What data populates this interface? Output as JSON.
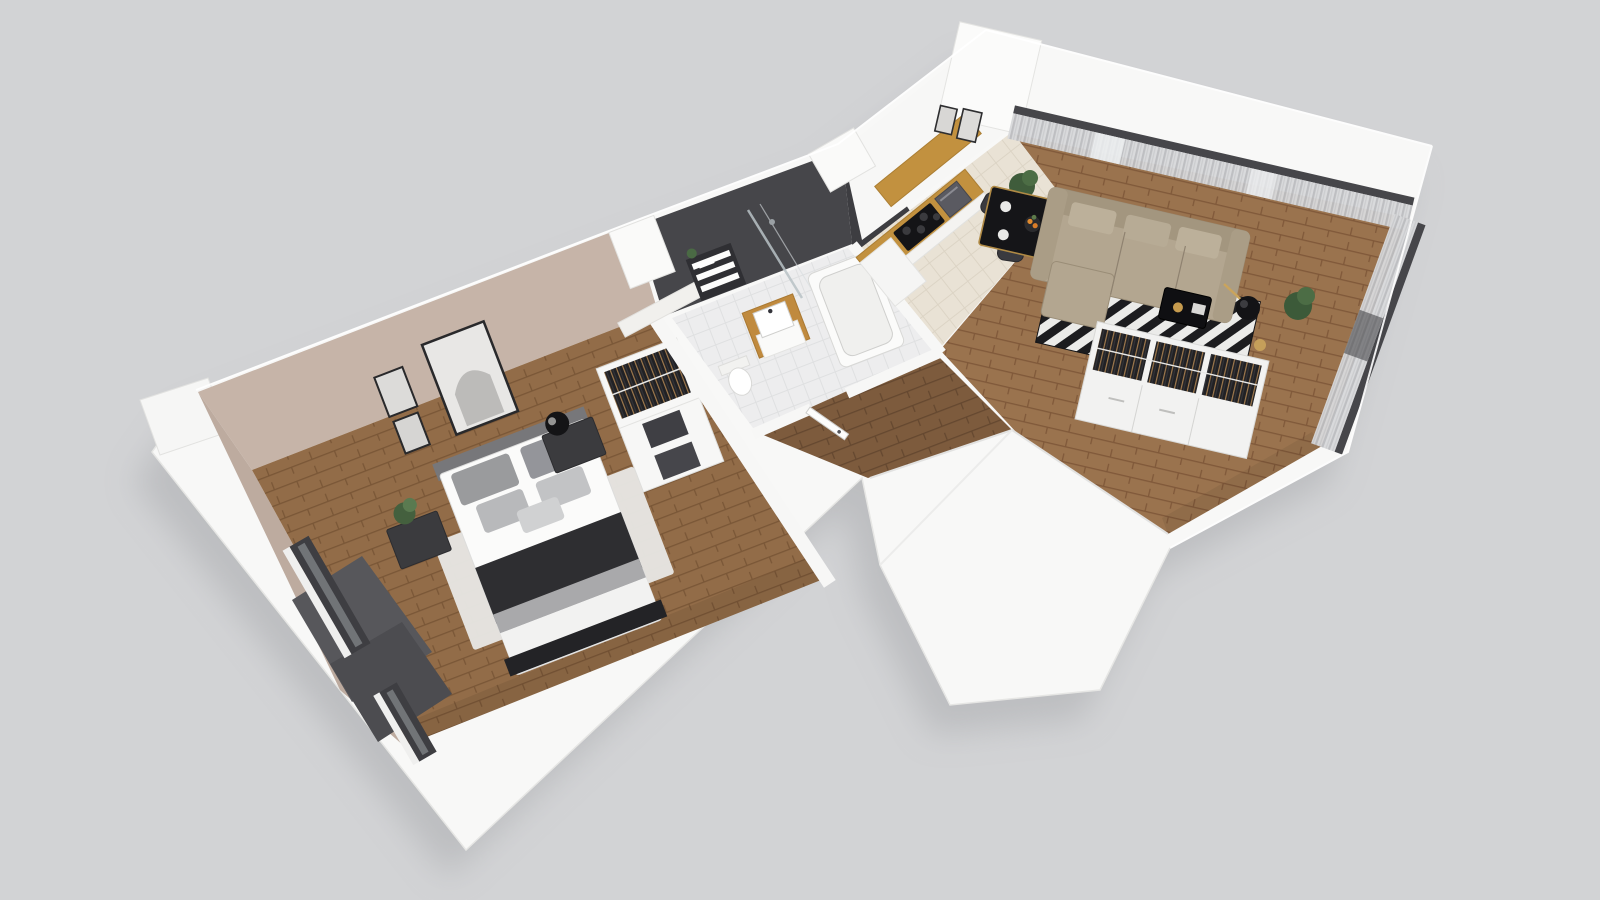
{
  "scene": {
    "type": "3d-floorplan-cutaway",
    "description": "Axonometric dollhouse cutaway view of a one-bedroom apartment floating on a plain gray background",
    "background": "#d2d3d5"
  },
  "palette": {
    "wall_white": "#f8f8f7",
    "wall_outer_shade": "#eeeeec",
    "bedroom_wall_taupe": "#c6b4a8",
    "bath_tile_dark": "#47474b",
    "bath_tile_white_brick": "#f1f0ed",
    "bedroom_floor_wood": "#926c48",
    "hall_floor_wood": "#7d5b3d",
    "living_floor_wood": "#9a734e",
    "kitchen_tile_beige": "#e9e2d5",
    "kitchen_wood_accent": "#c2913f",
    "cooktop_black": "#141417",
    "sofa_beige": "#b3a690",
    "rug_stripe_black": "#1c1c1f",
    "rug_stripe_white": "#ebebe9",
    "bedroom_rug_gray": "#e6e5e2",
    "curtain_gray": "#c9cacc",
    "window_frame_dark": "#3e3e42",
    "furniture_dark": "#3a3a3e",
    "throw_blanket_dark": "#2e2e31",
    "brass_accent": "#b08a45",
    "plant_green": "#44603e",
    "balcony_slab_gray": "#57575b"
  },
  "rooms": [
    {
      "name": "bedroom",
      "furniture": [
        "double-bed",
        "gray-area-rug",
        "nightstand-with-plant",
        "nightstand-with-lamp",
        "wall-art-frames",
        "white-wardrobe-shelving",
        "left-wall-windows",
        "radiator"
      ]
    },
    {
      "name": "bathroom",
      "furniture": [
        "vanity-sink-wood-top",
        "toilet",
        "bathtub",
        "walk-in-shower",
        "wall-shelves-with-towels",
        "white-brick-accent-wall"
      ]
    },
    {
      "name": "hallway",
      "furniture": [
        "entrance-door"
      ]
    },
    {
      "name": "kitchen",
      "furniture": [
        "counter-with-cooktop",
        "oven",
        "wood-backsplash-panel",
        "white-cabinets",
        "wall-art-frames"
      ]
    },
    {
      "name": "dining-area",
      "furniture": [
        "black-table-brass-trim",
        "four-dark-chairs",
        "table-setting",
        "potted-plant"
      ]
    },
    {
      "name": "living-room",
      "furniture": [
        "beige-corner-sofa",
        "black-white-striped-rug",
        "black-coffee-table",
        "floor-lamp",
        "open-wardrobe-with-clothes",
        "sheer-curtained-windows",
        "balcony-door",
        "potted-plants"
      ]
    },
    {
      "name": "exterior",
      "furniture": [
        "balcony-slabs",
        "entrance-vestibule-block",
        "chimney-blocks"
      ]
    }
  ]
}
